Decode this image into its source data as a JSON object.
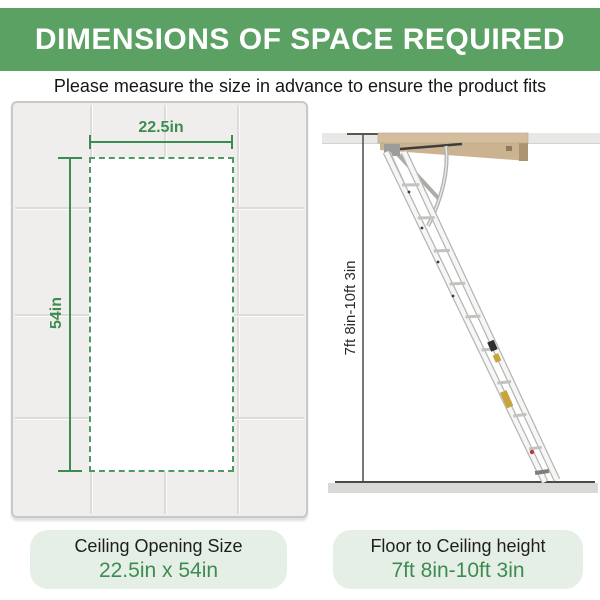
{
  "header": {
    "title": "DIMENSIONS OF SPACE REQUIRED"
  },
  "subtitle": "Please measure the size in advance to ensure the product fits",
  "ceiling_diagram": {
    "width_dimension": "22.5in",
    "height_dimension": "54in"
  },
  "ladder_diagram": {
    "height_dimension": "7ft 8in-10ft 3in"
  },
  "summary": {
    "opening": {
      "title": "Ceiling Opening Size",
      "value": "22.5in x 54in"
    },
    "height": {
      "title": "Floor to Ceiling height",
      "value": "7ft 8in-10ft 3in"
    }
  },
  "colors": {
    "header_bg": "#5ca164",
    "accent_green": "#3c8c52",
    "box_bg": "#e6efe6"
  }
}
